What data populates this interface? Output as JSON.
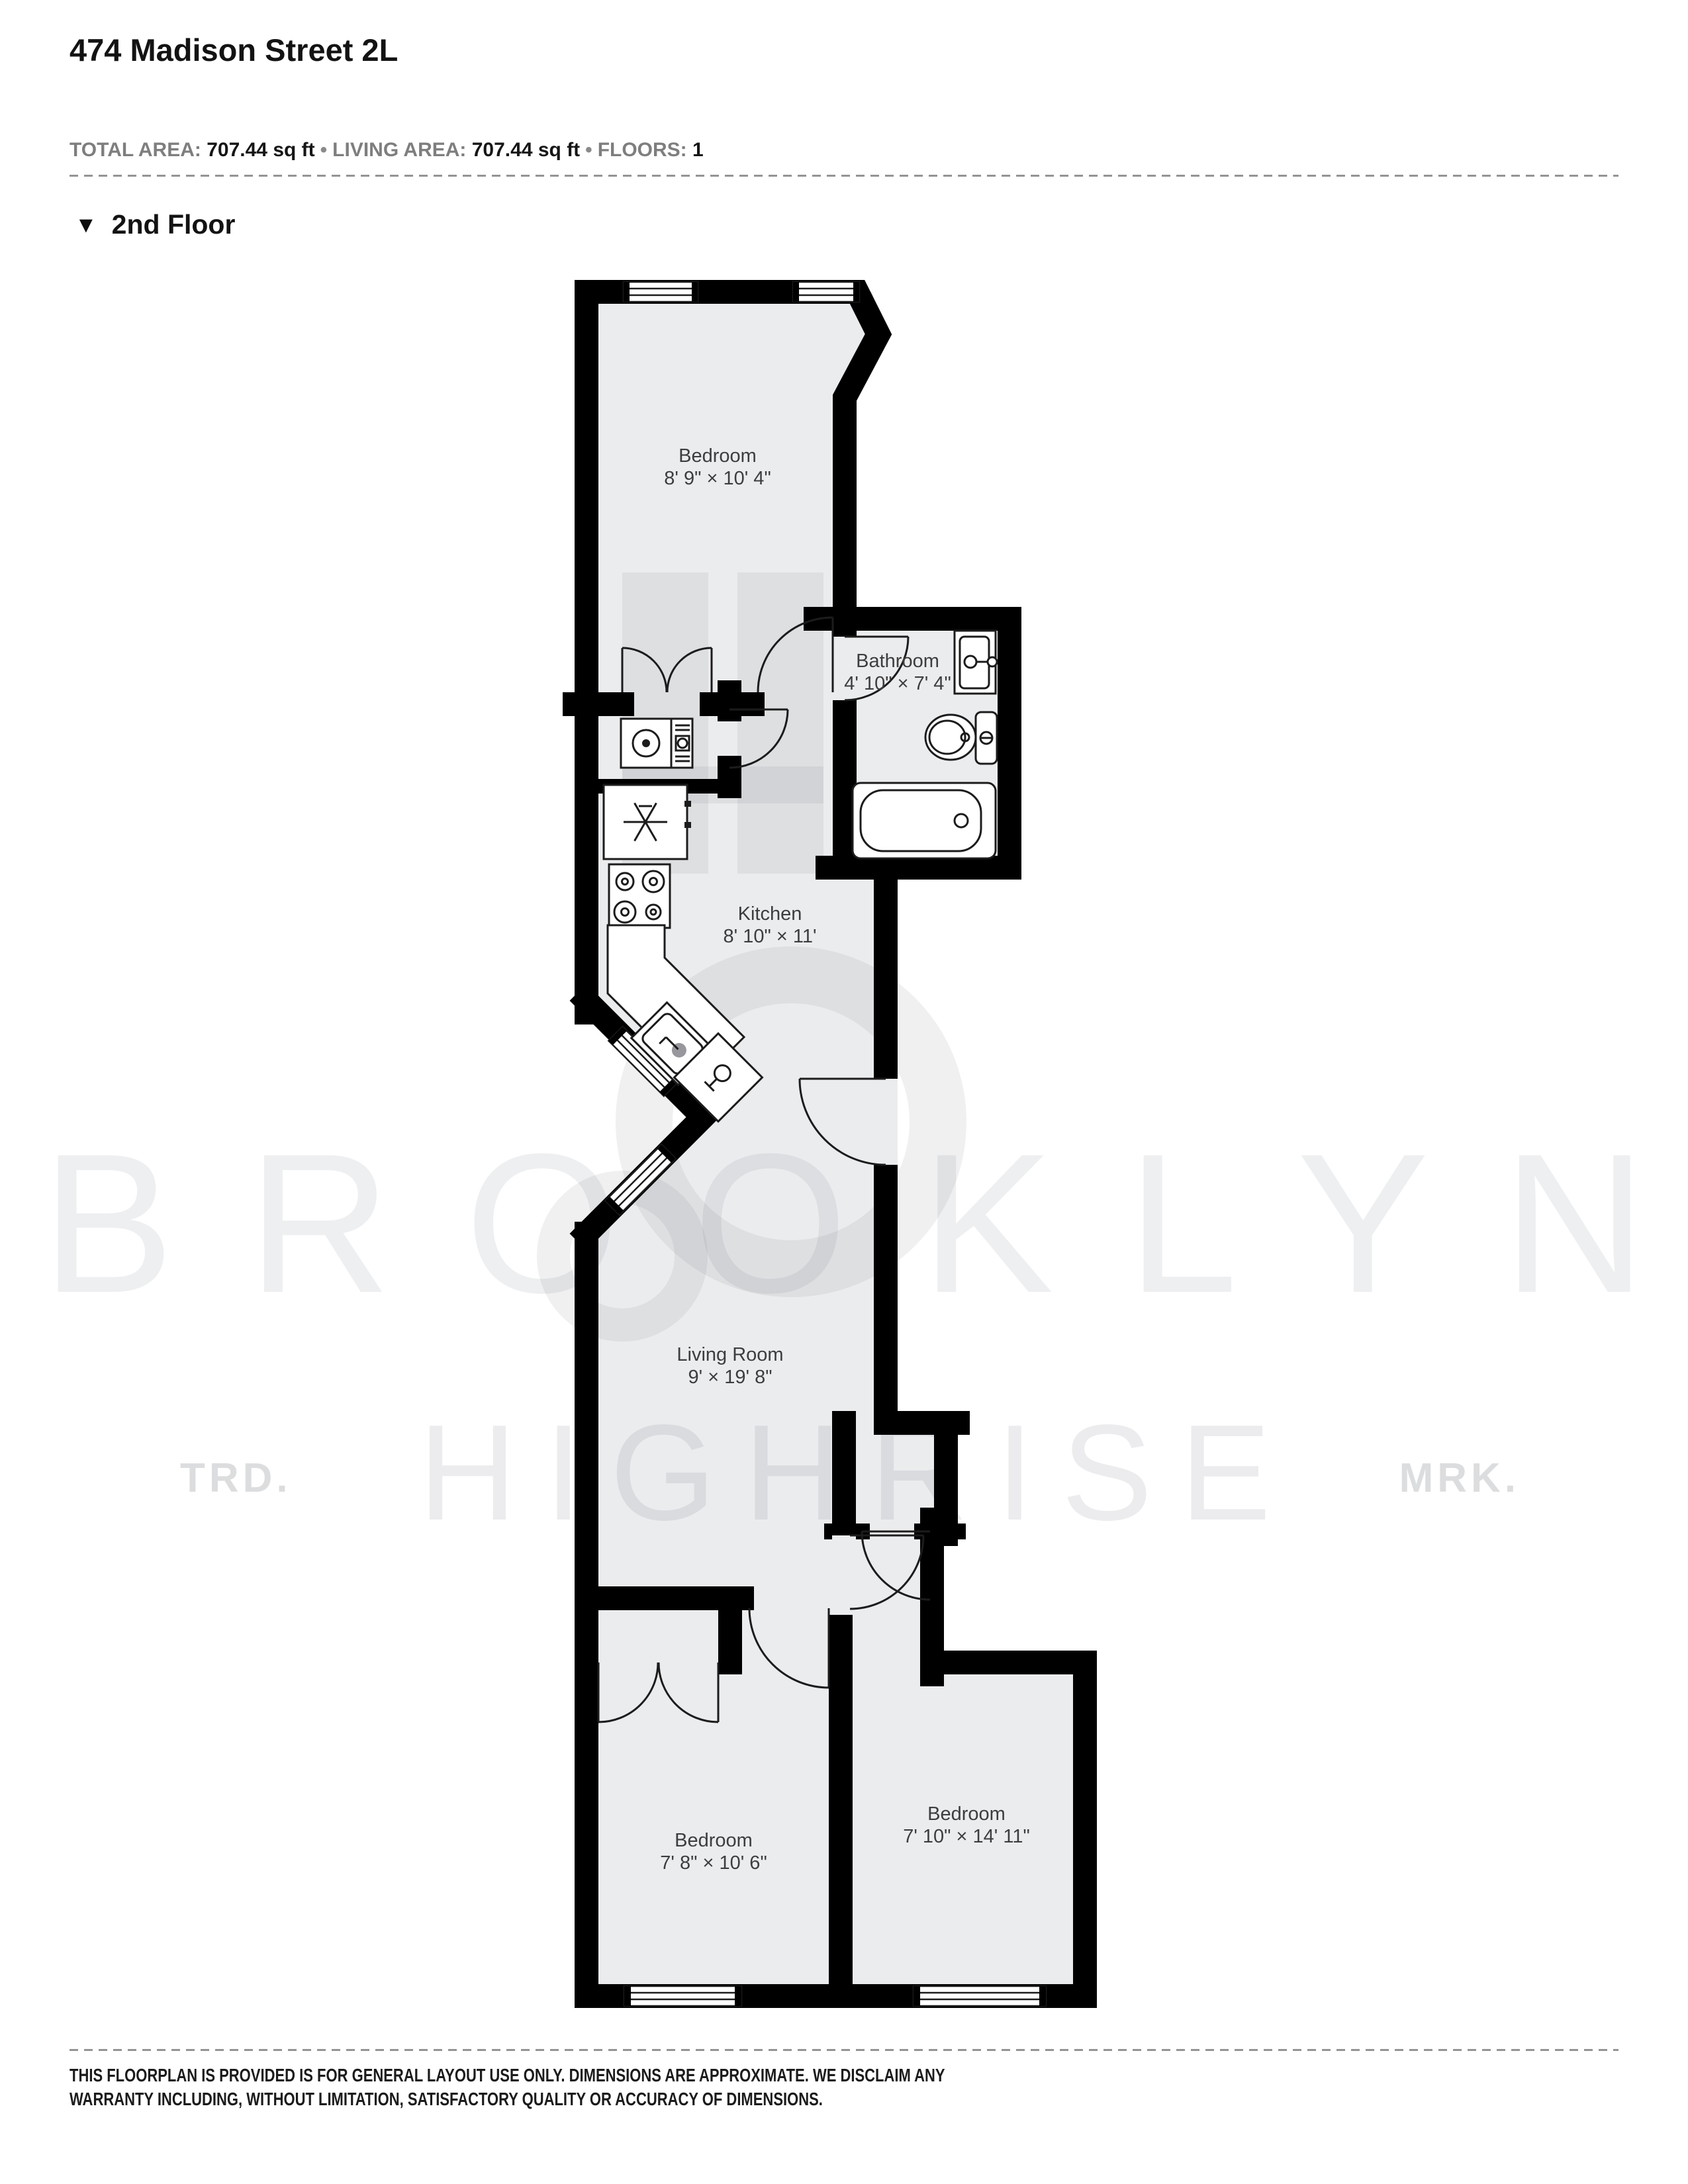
{
  "header": {
    "title": "474 Madison Street 2L",
    "meta": {
      "total_area_label": "TOTAL AREA:",
      "total_area_value": "707.44 sq ft",
      "living_area_label": "LIVING AREA:",
      "living_area_value": "707.44 sq ft",
      "floors_label": "FLOORS:",
      "floors_value": "1",
      "separator": "•"
    },
    "floor_section": {
      "marker_icon": "▼",
      "label": "2nd Floor"
    }
  },
  "floorplan": {
    "floor_name": "2nd Floor",
    "rooms": [
      {
        "name": "Bedroom",
        "dims": "8' 9\" × 10' 4\""
      },
      {
        "name": "Bathroom",
        "dims": "4' 10\" × 7' 4\""
      },
      {
        "name": "Kitchen",
        "dims": "8' 10\" × 11'"
      },
      {
        "name": "Living Room",
        "dims": "9' × 19' 8\""
      },
      {
        "name": "Bedroom",
        "dims": "7' 8\" × 10' 6\""
      },
      {
        "name": "Bedroom",
        "dims": "7' 10\" × 14' 11\""
      }
    ],
    "fixtures": [
      "washer-dryer",
      "refrigerator",
      "stove",
      "kitchen-sink",
      "dishwasher",
      "bathroom-sink",
      "toilet",
      "bathtub"
    ],
    "colors": {
      "wall": "#000000",
      "floor": "#ebecee",
      "fixture_outline": "#1c1c1c",
      "label_text": "#3d3d3d"
    }
  },
  "watermark": {
    "line1": "BROOKLYN",
    "line2": "HIGHRISE",
    "left_tag": "TRD.",
    "right_tag": "MRK."
  },
  "footer": {
    "disclaimer_line1": "THIS FLOORPLAN IS PROVIDED IS FOR GENERAL LAYOUT USE ONLY. DIMENSIONS ARE APPROXIMATE. WE DISCLAIM ANY",
    "disclaimer_line2": "WARRANTY INCLUDING, WITHOUT LIMITATION, SATISFACTORY QUALITY OR ACCURACY OF DIMENSIONS."
  }
}
